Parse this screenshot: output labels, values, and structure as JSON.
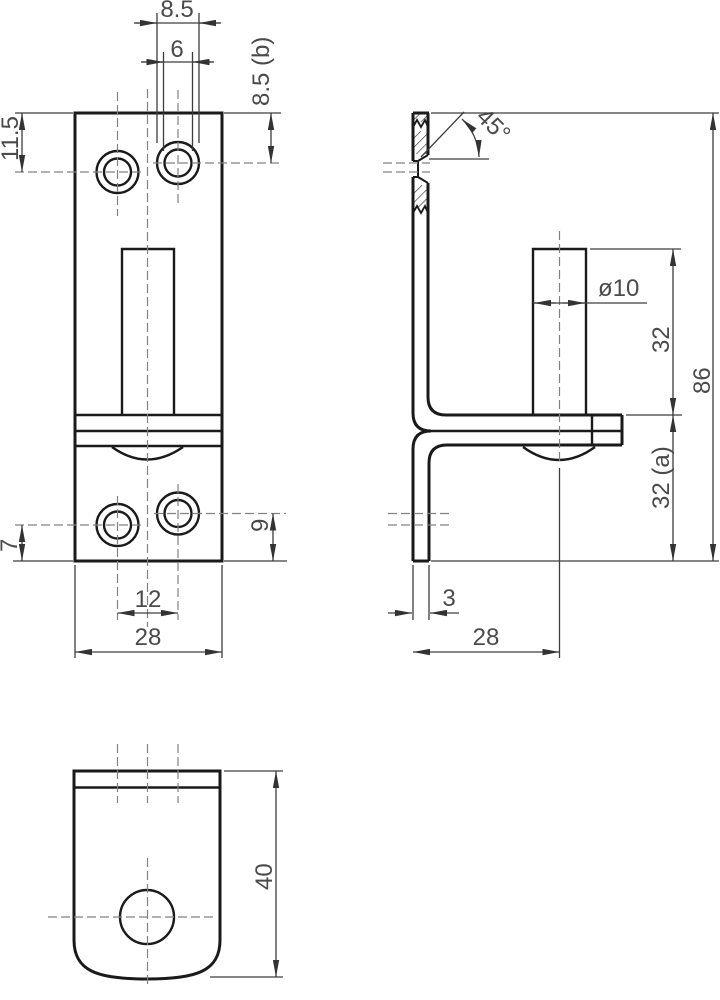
{
  "drawing": {
    "type": "orthographic technical drawing, 3 views",
    "colors": {
      "background": "#ffffff",
      "outline": "#1a1a1a",
      "dimension_lines": "#3d3d3d",
      "center_lines": "#828282",
      "dimension_text": "#4a4a4a"
    },
    "front_view": {
      "dimensions": {
        "csk_diameter": "8.5",
        "hole_diameter": "6",
        "top_right_hole_offset": "8.5 (b)",
        "top_left_hole_offset": "11.5",
        "bottom_left_hole_offset": "7",
        "bottom_right_hole_offset": "9",
        "hole_spacing": "12",
        "width": "28"
      }
    },
    "side_view": {
      "dimensions": {
        "chamfer_angle": "45°",
        "pin_diameter": "ø10",
        "pin_length": "32",
        "total_height": "86",
        "lower_section": "32 (a)",
        "plate_thickness": "3",
        "depth": "28"
      }
    },
    "bottom_view": {
      "dimensions": {
        "length": "40"
      }
    }
  }
}
